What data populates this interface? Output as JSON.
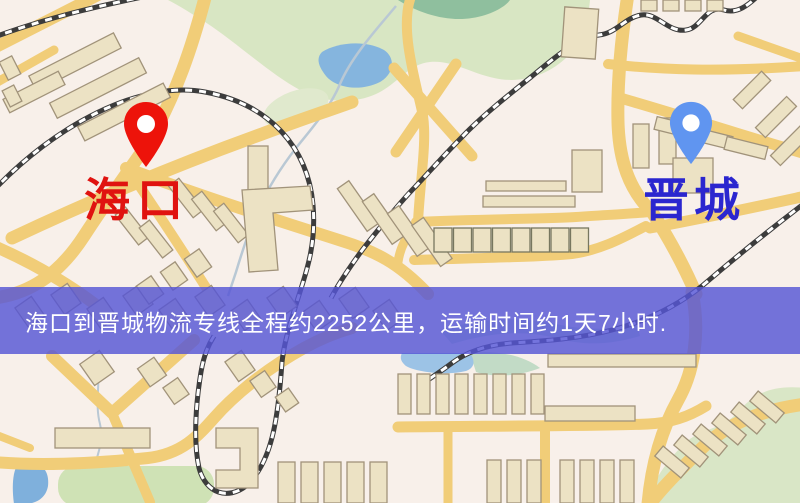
{
  "route_banner": {
    "text": "海口到晋城物流专线全程约2252公里，运输时间约1天7小时.",
    "distance": "约2252公里",
    "duration": "约1天7小时",
    "background_color": "rgba(86,86,214,0.82)",
    "text_color": "#ffffff"
  },
  "markers": {
    "origin": {
      "label": "海口",
      "icon": "map-pin-icon",
      "pin_color": "#ed130a",
      "label_color": "#e01310"
    },
    "destination": {
      "label": "晋城",
      "icon": "map-pin-icon",
      "pin_color": "#6095f0",
      "label_color": "#2b26cf"
    }
  },
  "map_palette": {
    "background": "#f8f0ea",
    "road": "#f1cd78",
    "building": "#ece2c4",
    "park": "#d8e6c3",
    "water": "#85b5de",
    "railway": "#3c3c3c"
  }
}
